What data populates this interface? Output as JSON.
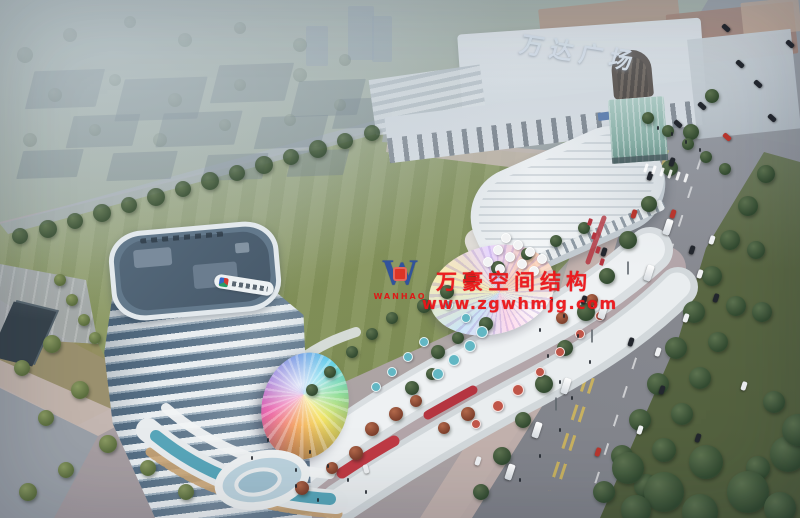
{
  "scene": {
    "meta": {
      "type": "architectural-rendering",
      "view": "aerial",
      "time": "dusk"
    },
    "labels": {
      "wanda_sign": "万达广场",
      "watermark_line1": "万豪空间结构",
      "watermark_line2": "www.zgwhmjg.com",
      "watermark_logo_letter": "W",
      "watermark_logo_name": "WANHAO"
    },
    "palette": {
      "watermark_red": "#ed1418",
      "watermark_blue": "#2d50a0",
      "wanda_sign_color": "#e4ecf6",
      "haze": "#b2c0cb",
      "lawn": "#87955d",
      "road": "#84868d",
      "verge_green": "#4f5d3c",
      "tower_glass": "#566f85",
      "tower_white": "#e8edf0",
      "pool_teal": "#3e9ab0",
      "mall_white": "#eef1f3",
      "accent_red": "#bf3a44",
      "plaza_pink": "#c3b2ae",
      "tree_green": "#3a5237",
      "canopy_rainbow": [
        "#e94fa1",
        "#8a5fd0",
        "#3f6fd8",
        "#43c8e8",
        "#f2e14c",
        "#f29b4a"
      ]
    },
    "blocks": [
      [
        30,
        70,
        70,
        38
      ],
      [
        120,
        78,
        82,
        42
      ],
      [
        215,
        64,
        74,
        38
      ],
      [
        295,
        80,
        66,
        36
      ],
      [
        70,
        115,
        66,
        32
      ],
      [
        160,
        112,
        78,
        34
      ],
      [
        258,
        116,
        66,
        32
      ],
      [
        336,
        98,
        56,
        30
      ],
      [
        20,
        150,
        60,
        28
      ],
      [
        110,
        152,
        64,
        28
      ],
      [
        205,
        154,
        60,
        26
      ],
      [
        290,
        150,
        56,
        26
      ]
    ],
    "slabs": [
      [
        348,
        6,
        26,
        54
      ],
      [
        372,
        16,
        20,
        46
      ],
      [
        306,
        26,
        22,
        40
      ]
    ],
    "trees": {
      "hazy": [
        [
          25,
          55,
          8
        ],
        [
          70,
          35,
          7
        ],
        [
          130,
          22,
          6
        ],
        [
          185,
          40,
          7
        ],
        [
          240,
          28,
          6
        ],
        [
          300,
          45,
          7
        ],
        [
          55,
          95,
          7
        ],
        [
          115,
          80,
          6
        ],
        [
          175,
          100,
          7
        ],
        [
          240,
          85,
          6
        ],
        [
          300,
          75,
          7
        ],
        [
          345,
          60,
          6
        ],
        [
          30,
          140,
          7
        ],
        [
          95,
          130,
          6
        ],
        [
          160,
          140,
          7
        ],
        [
          225,
          125,
          6
        ],
        [
          290,
          120,
          6
        ],
        [
          340,
          105,
          6
        ]
      ],
      "row": [
        [
          372,
          133,
          8
        ],
        [
          345,
          141,
          8
        ],
        [
          318,
          149,
          9
        ],
        [
          291,
          157,
          8
        ],
        [
          264,
          165,
          9
        ],
        [
          237,
          173,
          8
        ],
        [
          210,
          181,
          9
        ],
        [
          183,
          189,
          8
        ],
        [
          156,
          197,
          9
        ],
        [
          129,
          205,
          8
        ],
        [
          102,
          213,
          9
        ],
        [
          75,
          221,
          8
        ],
        [
          48,
          229,
          9
        ],
        [
          20,
          236,
          8
        ]
      ],
      "road": [
        [
          712,
          96,
          7
        ],
        [
          691,
          132,
          8
        ],
        [
          670,
          168,
          8
        ],
        [
          649,
          204,
          8
        ],
        [
          628,
          240,
          9
        ],
        [
          607,
          276,
          8
        ],
        [
          586,
          312,
          9
        ],
        [
          565,
          348,
          8
        ],
        [
          544,
          384,
          9
        ],
        [
          523,
          420,
          8
        ],
        [
          502,
          456,
          9
        ],
        [
          481,
          492,
          8
        ]
      ],
      "verge": [
        [
          766,
          174,
          9
        ],
        [
          748,
          206,
          10
        ],
        [
          730,
          240,
          10
        ],
        [
          756,
          250,
          9
        ],
        [
          712,
          276,
          10
        ],
        [
          736,
          306,
          10
        ],
        [
          694,
          312,
          11
        ],
        [
          718,
          342,
          10
        ],
        [
          676,
          348,
          11
        ],
        [
          700,
          378,
          11
        ],
        [
          658,
          384,
          11
        ],
        [
          682,
          414,
          11
        ],
        [
          640,
          420,
          11
        ],
        [
          664,
          450,
          12
        ],
        [
          622,
          456,
          11
        ],
        [
          646,
          486,
          12
        ],
        [
          604,
          492,
          11
        ],
        [
          762,
          312,
          10
        ],
        [
          774,
          402,
          11
        ],
        [
          758,
          468,
          12
        ]
      ],
      "corner": [
        [
          628,
          468,
          16
        ],
        [
          664,
          492,
          20
        ],
        [
          706,
          462,
          17
        ],
        [
          748,
          492,
          21
        ],
        [
          788,
          454,
          18
        ],
        [
          636,
          510,
          15
        ],
        [
          700,
          512,
          18
        ],
        [
          780,
          508,
          16
        ],
        [
          798,
          430,
          16
        ]
      ],
      "walk": [
        [
          648,
          118,
          6
        ],
        [
          668,
          131,
          6
        ],
        [
          688,
          144,
          6
        ],
        [
          706,
          157,
          6
        ],
        [
          725,
          169,
          6
        ]
      ],
      "complex_green": [
        [
          424,
          306,
          7
        ],
        [
          447,
          292,
          7
        ],
        [
          470,
          278,
          6
        ],
        [
          498,
          268,
          7
        ],
        [
          527,
          254,
          6
        ],
        [
          556,
          241,
          6
        ],
        [
          438,
          352,
          7
        ],
        [
          458,
          338,
          6
        ],
        [
          486,
          324,
          7
        ],
        [
          412,
          388,
          7
        ],
        [
          432,
          374,
          6
        ],
        [
          584,
          228,
          6
        ],
        [
          392,
          318,
          6
        ],
        [
          372,
          334,
          6
        ],
        [
          352,
          352,
          6
        ],
        [
          330,
          372,
          6
        ],
        [
          312,
          390,
          6
        ]
      ],
      "complex_red": [
        [
          396,
          414,
          7
        ],
        [
          416,
          401,
          6
        ],
        [
          372,
          429,
          7
        ],
        [
          444,
          428,
          6
        ],
        [
          468,
          414,
          7
        ],
        [
          356,
          453,
          7
        ],
        [
          332,
          468,
          6
        ],
        [
          302,
          488,
          7
        ],
        [
          562,
          318,
          6
        ],
        [
          592,
          300,
          6
        ]
      ],
      "left": [
        [
          52,
          344,
          9
        ],
        [
          22,
          368,
          8
        ],
        [
          80,
          390,
          9
        ],
        [
          46,
          418,
          8
        ],
        [
          108,
          444,
          9
        ],
        [
          66,
          470,
          8
        ],
        [
          28,
          492,
          9
        ],
        [
          148,
          468,
          8
        ],
        [
          186,
          492,
          8
        ],
        [
          60,
          280,
          6
        ],
        [
          72,
          300,
          6
        ],
        [
          84,
          320,
          6
        ],
        [
          95,
          338,
          6
        ]
      ]
    },
    "umbrellas": {
      "white": [
        [
          506,
          238,
          4
        ],
        [
          518,
          245,
          4
        ],
        [
          530,
          252,
          4
        ],
        [
          542,
          259,
          4
        ],
        [
          498,
          250,
          4
        ],
        [
          510,
          257,
          4
        ],
        [
          522,
          264,
          4
        ],
        [
          534,
          271,
          4
        ],
        [
          488,
          262,
          4
        ],
        [
          500,
          269,
          4
        ]
      ],
      "teal": [
        [
          470,
          346,
          5
        ],
        [
          454,
          360,
          5
        ],
        [
          438,
          374,
          5
        ],
        [
          482,
          332,
          5
        ],
        [
          466,
          318,
          4
        ],
        [
          448,
          305,
          4
        ],
        [
          424,
          342,
          4
        ],
        [
          408,
          357,
          4
        ],
        [
          392,
          372,
          4
        ],
        [
          376,
          387,
          4
        ]
      ],
      "red": [
        [
          518,
          390,
          5
        ],
        [
          540,
          372,
          4
        ],
        [
          498,
          406,
          5
        ],
        [
          476,
          424,
          4
        ],
        [
          560,
          352,
          4
        ],
        [
          580,
          334,
          4
        ],
        [
          600,
          316,
          4
        ]
      ]
    },
    "vehicles": {
      "buses": [
        [
          668,
          227,
          18
        ],
        [
          649,
          273,
          18
        ],
        [
          603,
          311,
          18
        ],
        [
          566,
          386,
          18
        ],
        [
          537,
          430,
          18
        ],
        [
          510,
          472,
          18
        ]
      ],
      "cars_white": [
        [
          686,
          318,
          18
        ],
        [
          700,
          274,
          18
        ],
        [
          712,
          240,
          18
        ],
        [
          658,
          352,
          18
        ],
        [
          640,
          430,
          18
        ],
        [
          478,
          461,
          18
        ],
        [
          744,
          386,
          18
        ],
        [
          366,
          469,
          -15
        ]
      ],
      "cars_dark": [
        [
          702,
          106,
          -48
        ],
        [
          678,
          124,
          -48
        ],
        [
          740,
          64,
          -48
        ],
        [
          758,
          84,
          -48
        ],
        [
          772,
          118,
          -48
        ],
        [
          726,
          28,
          -48
        ],
        [
          790,
          44,
          -48
        ],
        [
          650,
          176,
          18
        ],
        [
          692,
          250,
          18
        ],
        [
          716,
          298,
          18
        ],
        [
          662,
          390,
          18
        ],
        [
          698,
          438,
          18
        ],
        [
          622,
          466,
          18
        ],
        [
          584,
          300,
          18
        ],
        [
          604,
          252,
          18
        ],
        [
          631,
          342,
          18
        ],
        [
          672,
          162,
          18
        ]
      ],
      "cars_red": [
        [
          634,
          214,
          18
        ],
        [
          727,
          137,
          -48
        ],
        [
          598,
          452,
          18
        ],
        [
          673,
          214,
          18
        ]
      ]
    },
    "people": [
      [
        552,
        300
      ],
      [
        564,
        316
      ],
      [
        578,
        336
      ],
      [
        548,
        356
      ],
      [
        590,
        362
      ],
      [
        560,
        382
      ],
      [
        572,
        398
      ],
      [
        540,
        330
      ],
      [
        310,
        452
      ],
      [
        328,
        466
      ],
      [
        296,
        470
      ],
      [
        348,
        480
      ],
      [
        366,
        492
      ],
      [
        268,
        440
      ],
      [
        252,
        458
      ],
      [
        296,
        486
      ],
      [
        318,
        500
      ],
      [
        658,
        128
      ],
      [
        672,
        134
      ],
      [
        686,
        142
      ],
      [
        700,
        150
      ],
      [
        560,
        430
      ],
      [
        540,
        456
      ],
      [
        520,
        480
      ]
    ],
    "lamps": [
      [
        592,
        336
      ],
      [
        556,
        404
      ],
      [
        628,
        268
      ]
    ],
    "crosswalk": [
      [
        646,
        168
      ],
      [
        654,
        170
      ],
      [
        662,
        172
      ],
      [
        670,
        174
      ],
      [
        678,
        176
      ],
      [
        686,
        178
      ]
    ],
    "red_shop_dots": [
      [
        590,
        222
      ],
      [
        594,
        236
      ],
      [
        598,
        250
      ],
      [
        602,
        262
      ]
    ]
  }
}
